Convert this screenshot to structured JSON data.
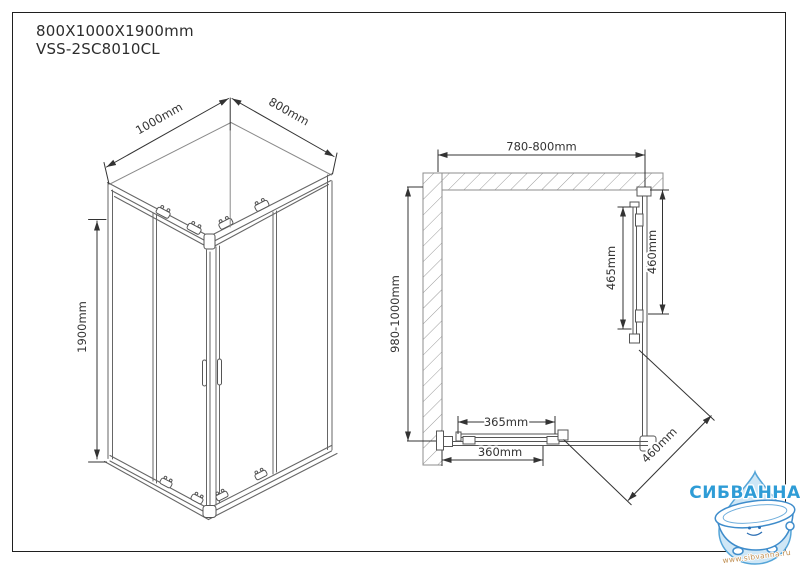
{
  "header": {
    "size_label": "800X1000X1900mm",
    "model_label": "VSS-2SC8010CL"
  },
  "isometric_view": {
    "width_dim": "1000mm",
    "depth_dim": "800mm",
    "height_dim": "1900mm"
  },
  "plan_view": {
    "overall_width_dim": "780-800mm",
    "overall_depth_dim": "980-1000mm",
    "side_door_dim": "465mm",
    "side_panel_dim": "460mm",
    "front_door_dim": "365mm",
    "front_panel_dim": "360mm",
    "diagonal_opening_dim": "460mm"
  },
  "watermark": {
    "brand": "СИБВАННА",
    "website": "www.sibvanna.ru",
    "brand_color": "#2E9CD6",
    "website_color": "#C08F52",
    "drop_fill": "#CFE7F6",
    "drop_stroke": "#55A5D8",
    "tub_stroke": "#3E8CCB"
  }
}
